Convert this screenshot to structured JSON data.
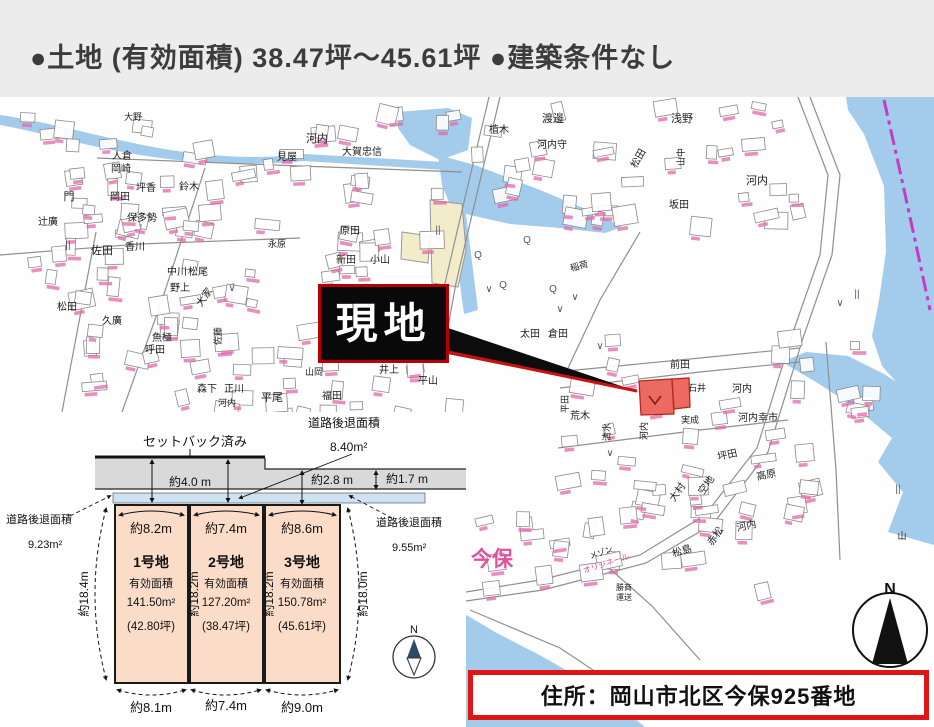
{
  "header": {
    "title": "●土地 (有効面積)  38.47坪～45.61坪  ●建築条件なし"
  },
  "site_callout": {
    "text": "現地"
  },
  "address_bar": {
    "text": "住所：岡山市北区今保925番地"
  },
  "colors": {
    "header_bg": "#ececec",
    "water": "#a3cbec",
    "boundary_magenta": "#c53bc1",
    "site_red": "#ec6a60",
    "lot_fill": "#fbdcc9",
    "setback_strip": "#cfe2f3",
    "road_gray": "#d9d9d9",
    "callout_red_border": "#b80000",
    "address_border": "#e01616",
    "pink_label": "#e0519c"
  },
  "map": {
    "compass_n": "N",
    "place_labels": [
      {
        "t": "大野",
        "x": 133,
        "y": 120,
        "s": 9
      },
      {
        "t": "人倉",
        "x": 122,
        "y": 159,
        "s": 10
      },
      {
        "t": "岡崎",
        "x": 121,
        "y": 172,
        "s": 10
      },
      {
        "t": "坪香",
        "x": 146,
        "y": 191,
        "s": 10
      },
      {
        "t": "岡田",
        "x": 120,
        "y": 200,
        "s": 10
      },
      {
        "t": "保多勢",
        "x": 142,
        "y": 221,
        "s": 10
      },
      {
        "t": "門",
        "x": 69,
        "y": 200,
        "s": 11
      },
      {
        "t": "辻廣",
        "x": 48,
        "y": 225,
        "s": 10
      },
      {
        "t": "佐田",
        "x": 102,
        "y": 254,
        "s": 11
      },
      {
        "t": "香川",
        "x": 135,
        "y": 250,
        "s": 10
      },
      {
        "t": "中川",
        "x": 177,
        "y": 275,
        "s": 10
      },
      {
        "t": "松尾",
        "x": 198,
        "y": 275,
        "s": 10
      },
      {
        "t": "鈴木",
        "x": 189,
        "y": 190,
        "s": 10
      },
      {
        "t": "見屋",
        "x": 287,
        "y": 160,
        "s": 10
      },
      {
        "t": "野上",
        "x": 180,
        "y": 291,
        "s": 10
      },
      {
        "t": "大家",
        "x": 207,
        "y": 299,
        "s": 10,
        "r": -55
      },
      {
        "t": "松田",
        "x": 67,
        "y": 310,
        "s": 10
      },
      {
        "t": "久廣",
        "x": 112,
        "y": 324,
        "s": 10
      },
      {
        "t": "魚極",
        "x": 162,
        "y": 341,
        "s": 10
      },
      {
        "t": "呼田",
        "x": 155,
        "y": 353,
        "s": 10
      },
      {
        "t": "佐藤",
        "x": 221,
        "y": 336,
        "s": 9,
        "r": -90
      },
      {
        "t": "森下",
        "x": 207,
        "y": 392,
        "s": 10
      },
      {
        "t": "正川",
        "x": 234,
        "y": 392,
        "s": 10
      },
      {
        "t": "平尾",
        "x": 272,
        "y": 401,
        "s": 11
      },
      {
        "t": "河内",
        "x": 227,
        "y": 406,
        "s": 9
      },
      {
        "t": "山岡",
        "x": 314,
        "y": 375,
        "s": 9
      },
      {
        "t": "井上",
        "x": 389,
        "y": 373,
        "s": 10
      },
      {
        "t": "平山",
        "x": 428,
        "y": 384,
        "s": 10
      },
      {
        "t": "福田",
        "x": 332,
        "y": 399,
        "s": 10
      },
      {
        "t": "永原",
        "x": 277,
        "y": 247,
        "s": 9
      },
      {
        "t": "河内",
        "x": 317,
        "y": 142,
        "s": 11
      },
      {
        "t": "大賀忠信",
        "x": 362,
        "y": 155,
        "s": 10
      },
      {
        "t": "原田",
        "x": 350,
        "y": 234,
        "s": 10
      },
      {
        "t": "新田",
        "x": 346,
        "y": 263,
        "s": 10
      },
      {
        "t": "小山",
        "x": 380,
        "y": 263,
        "s": 10
      },
      {
        "t": "植木",
        "x": 499,
        "y": 133,
        "s": 10
      },
      {
        "t": "渡邊",
        "x": 553,
        "y": 122,
        "s": 11
      },
      {
        "t": "河内守",
        "x": 552,
        "y": 148,
        "s": 10
      },
      {
        "t": "浅野",
        "x": 682,
        "y": 122,
        "s": 11
      },
      {
        "t": "松田",
        "x": 641,
        "y": 160,
        "s": 10,
        "r": -60
      },
      {
        "t": "山中",
        "x": 684,
        "y": 157,
        "s": 9,
        "r": -90
      },
      {
        "t": "河内",
        "x": 757,
        "y": 184,
        "s": 11
      },
      {
        "t": "坂田",
        "x": 679,
        "y": 208,
        "s": 10
      },
      {
        "t": "稲荷",
        "x": 580,
        "y": 269,
        "s": 9,
        "r": -15
      },
      {
        "t": "太田",
        "x": 530,
        "y": 337,
        "s": 10
      },
      {
        "t": "倉田",
        "x": 558,
        "y": 337,
        "s": 10
      },
      {
        "t": "清水",
        "x": 610,
        "y": 432,
        "s": 9,
        "r": -90
      },
      {
        "t": "荒木",
        "x": 580,
        "y": 419,
        "s": 10
      },
      {
        "t": "平田",
        "x": 568,
        "y": 404,
        "s": 9,
        "r": -90
      },
      {
        "t": "前田",
        "x": 680,
        "y": 368,
        "s": 10
      },
      {
        "t": "石井",
        "x": 697,
        "y": 391,
        "s": 9
      },
      {
        "t": "河内",
        "x": 742,
        "y": 392,
        "s": 10
      },
      {
        "t": "河内幸市",
        "x": 758,
        "y": 421,
        "s": 10
      },
      {
        "t": "実成",
        "x": 690,
        "y": 423,
        "s": 9
      },
      {
        "t": "河内",
        "x": 647,
        "y": 431,
        "s": 9,
        "r": -90
      },
      {
        "t": "坪田",
        "x": 728,
        "y": 458,
        "s": 10,
        "r": -12
      },
      {
        "t": "大村",
        "x": 680,
        "y": 494,
        "s": 10,
        "r": -55
      },
      {
        "t": "空地",
        "x": 709,
        "y": 487,
        "s": 10,
        "r": -55
      },
      {
        "t": "高原",
        "x": 767,
        "y": 478,
        "s": 10,
        "r": -12
      },
      {
        "t": "赤松",
        "x": 718,
        "y": 538,
        "s": 10,
        "r": -55
      },
      {
        "t": "河内",
        "x": 747,
        "y": 529,
        "s": 10,
        "r": -12
      },
      {
        "t": "松島",
        "x": 683,
        "y": 554,
        "s": 10,
        "r": -18
      },
      {
        "t": "勝商",
        "x": 624,
        "y": 590,
        "s": 8
      },
      {
        "t": "運送",
        "x": 624,
        "y": 600,
        "s": 8
      },
      {
        "t": "山",
        "x": 902,
        "y": 539,
        "s": 9
      },
      {
        "t": "メゾン",
        "x": 602,
        "y": 555,
        "s": 8,
        "r": -18
      },
      {
        "t": "オリジネール",
        "x": 607,
        "y": 566,
        "s": 8,
        "r": -18,
        "c": "p"
      },
      {
        "t": "今保",
        "x": 492,
        "y": 566,
        "s": 21,
        "c": "p",
        "b": 1
      }
    ],
    "symbols": [
      {
        "t": "∨",
        "x": 232,
        "y": 291
      },
      {
        "t": "∨",
        "x": 489,
        "y": 292
      },
      {
        "t": "∨",
        "x": 560,
        "y": 312
      },
      {
        "t": "∨",
        "x": 600,
        "y": 349
      },
      {
        "t": "∨",
        "x": 688,
        "y": 396
      },
      {
        "t": "∨",
        "x": 840,
        "y": 306
      },
      {
        "t": "∨",
        "x": 610,
        "y": 456
      },
      {
        "t": "∨",
        "x": 575,
        "y": 300
      },
      {
        "t": "Q",
        "x": 527,
        "y": 243
      },
      {
        "t": "Q",
        "x": 478,
        "y": 258
      },
      {
        "t": "Q",
        "x": 503,
        "y": 288
      },
      {
        "t": "Q",
        "x": 553,
        "y": 292
      },
      {
        "t": "||",
        "x": 68,
        "y": 248
      },
      {
        "t": "||",
        "x": 857,
        "y": 297
      },
      {
        "t": "||",
        "x": 438,
        "y": 233
      },
      {
        "t": "||",
        "x": 898,
        "y": 492
      }
    ]
  },
  "diagram": {
    "setback_note": "セットバック済み",
    "retreat_top": {
      "label": "道路後退面積",
      "area": "8.40m²"
    },
    "retreat_left": {
      "label": "道路後退面積",
      "area": "9.23m²"
    },
    "retreat_right": {
      "label": "道路後退面積",
      "area": "9.55m²"
    },
    "road_widths": [
      "約4.0 m",
      "約2.8 m",
      "約1.7 m"
    ],
    "lots": [
      {
        "name": "1号地",
        "eff_label": "有効面積",
        "area": "141.50m²",
        "tsubo": "(42.80坪)",
        "top_width": "約8.2m",
        "bottom_width": "約8.1m"
      },
      {
        "name": "2号地",
        "eff_label": "有効面積",
        "area": "127.20m²",
        "tsubo": "(38.47坪)",
        "top_width": "約7.4m",
        "bottom_width": "約7.4m"
      },
      {
        "name": "3号地",
        "eff_label": "有効面積",
        "area": "150.78m²",
        "tsubo": "(45.61坪)",
        "top_width": "約8.6m",
        "bottom_width": "約9.0m"
      }
    ],
    "side_dims": {
      "left": "約18.4m",
      "mid1": "約18.2m",
      "mid2": "約18.2m",
      "right": "約18.0m"
    },
    "compass_n": "N"
  }
}
